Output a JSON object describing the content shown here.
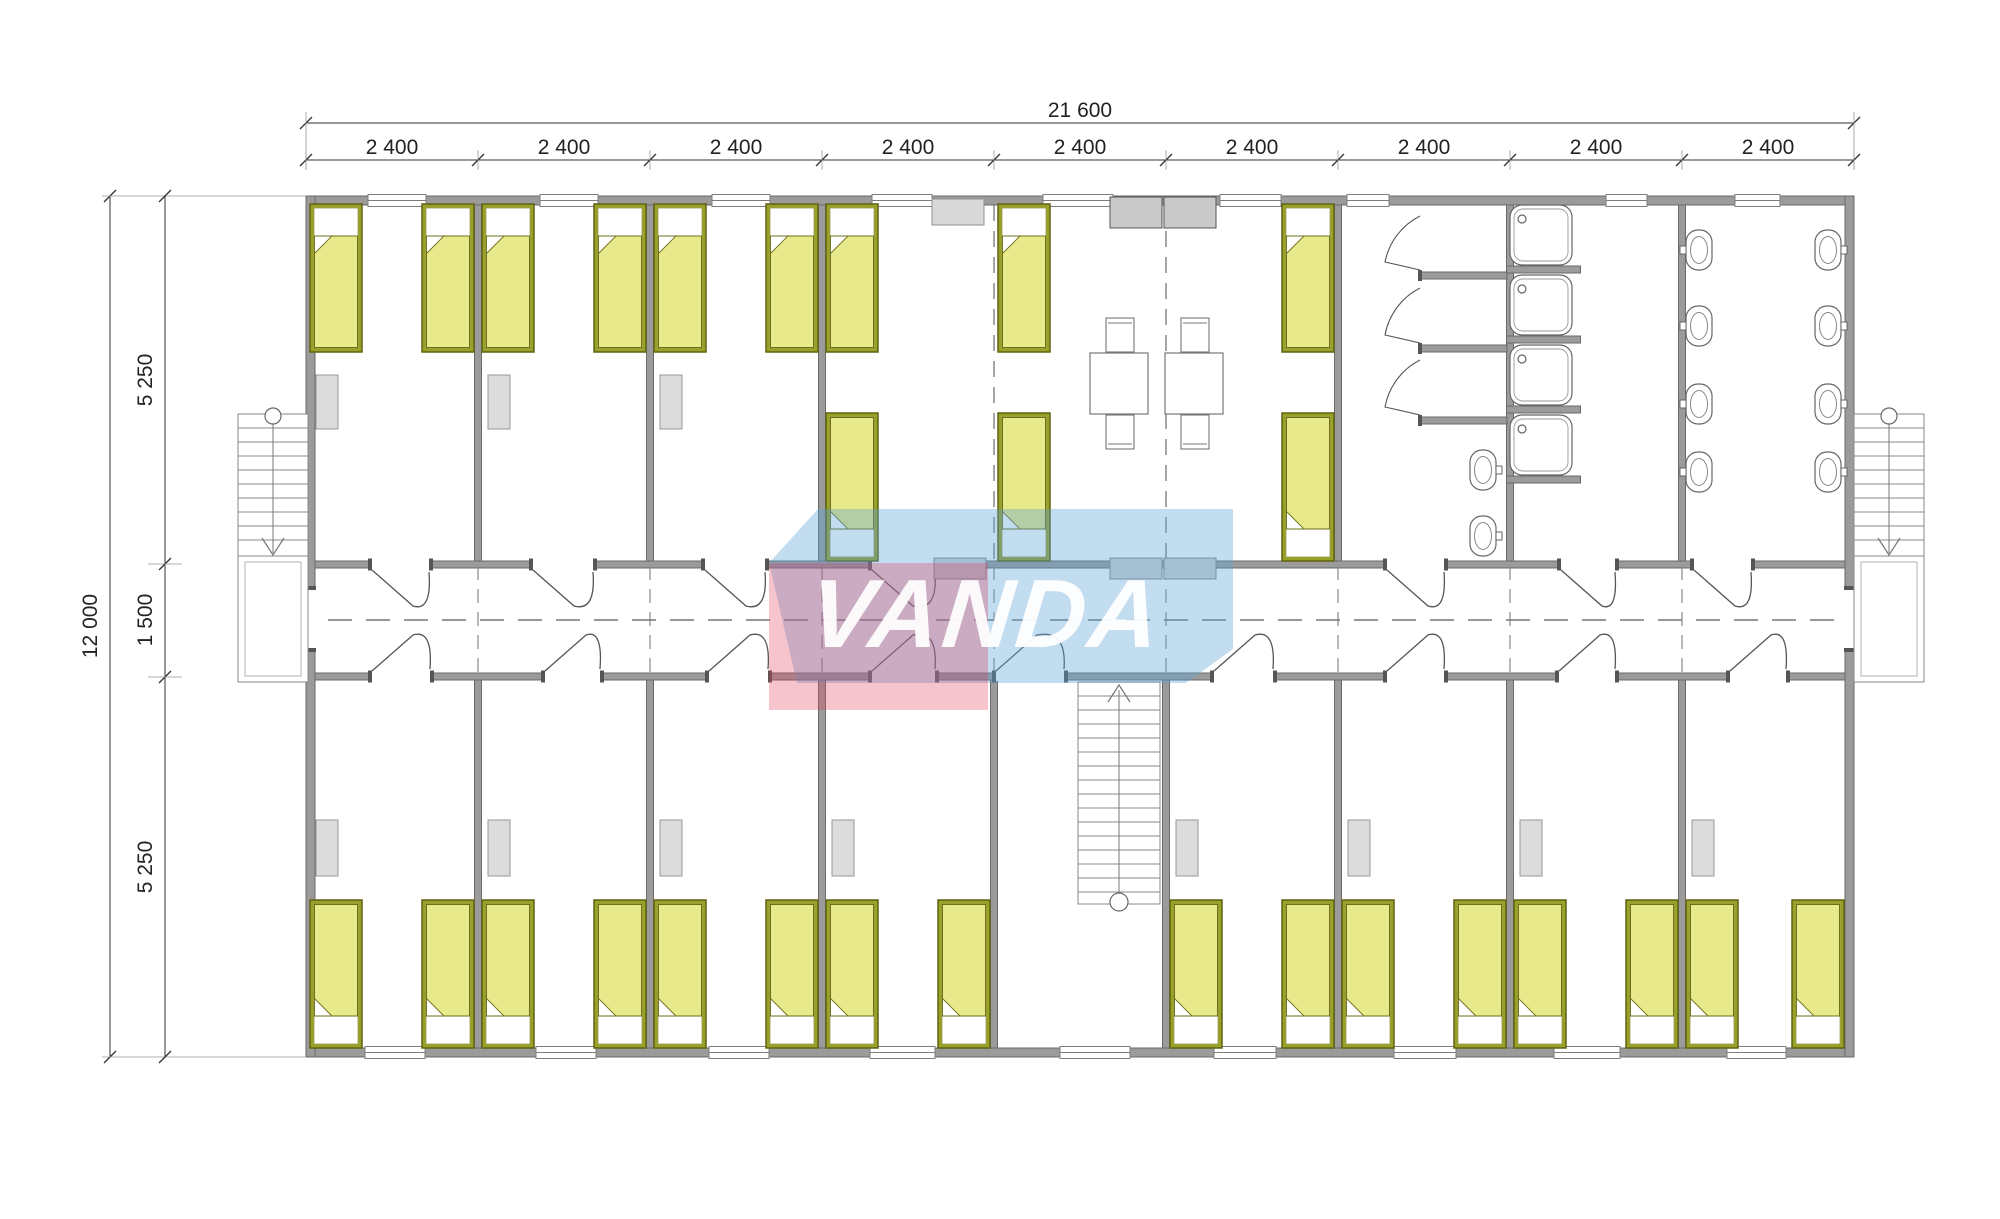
{
  "watermark": {
    "text": "VANDA"
  },
  "dimensions": {
    "top": {
      "total": "21 600",
      "segments": [
        "2 400",
        "2 400",
        "2 400",
        "2 400",
        "2 400",
        "2 400",
        "2 400",
        "2 400",
        "2 400"
      ]
    },
    "left": {
      "total": "12 000",
      "segments": [
        "5 250",
        "1 500",
        "5 250"
      ]
    }
  },
  "colors": {
    "wall": "#9b9b9b",
    "wall_outline": "#6a6a6a",
    "thin_line": "#555555",
    "light_line": "#888888",
    "bed_frame": "#99a126",
    "bed_frame_outline": "#5f6212",
    "bed_blanket": "#e8e98b",
    "bed_blanket_outline": "#6d7018",
    "wardrobe_fill": "#dcdcdc",
    "counter_fill": "#c9c9c9",
    "radiator_fill": "#d2d2d2",
    "watermark_pink": "rgba(225,60,90,0.30)",
    "watermark_blue": "rgba(90,160,215,0.37)",
    "dimension_color": "#333333"
  }
}
